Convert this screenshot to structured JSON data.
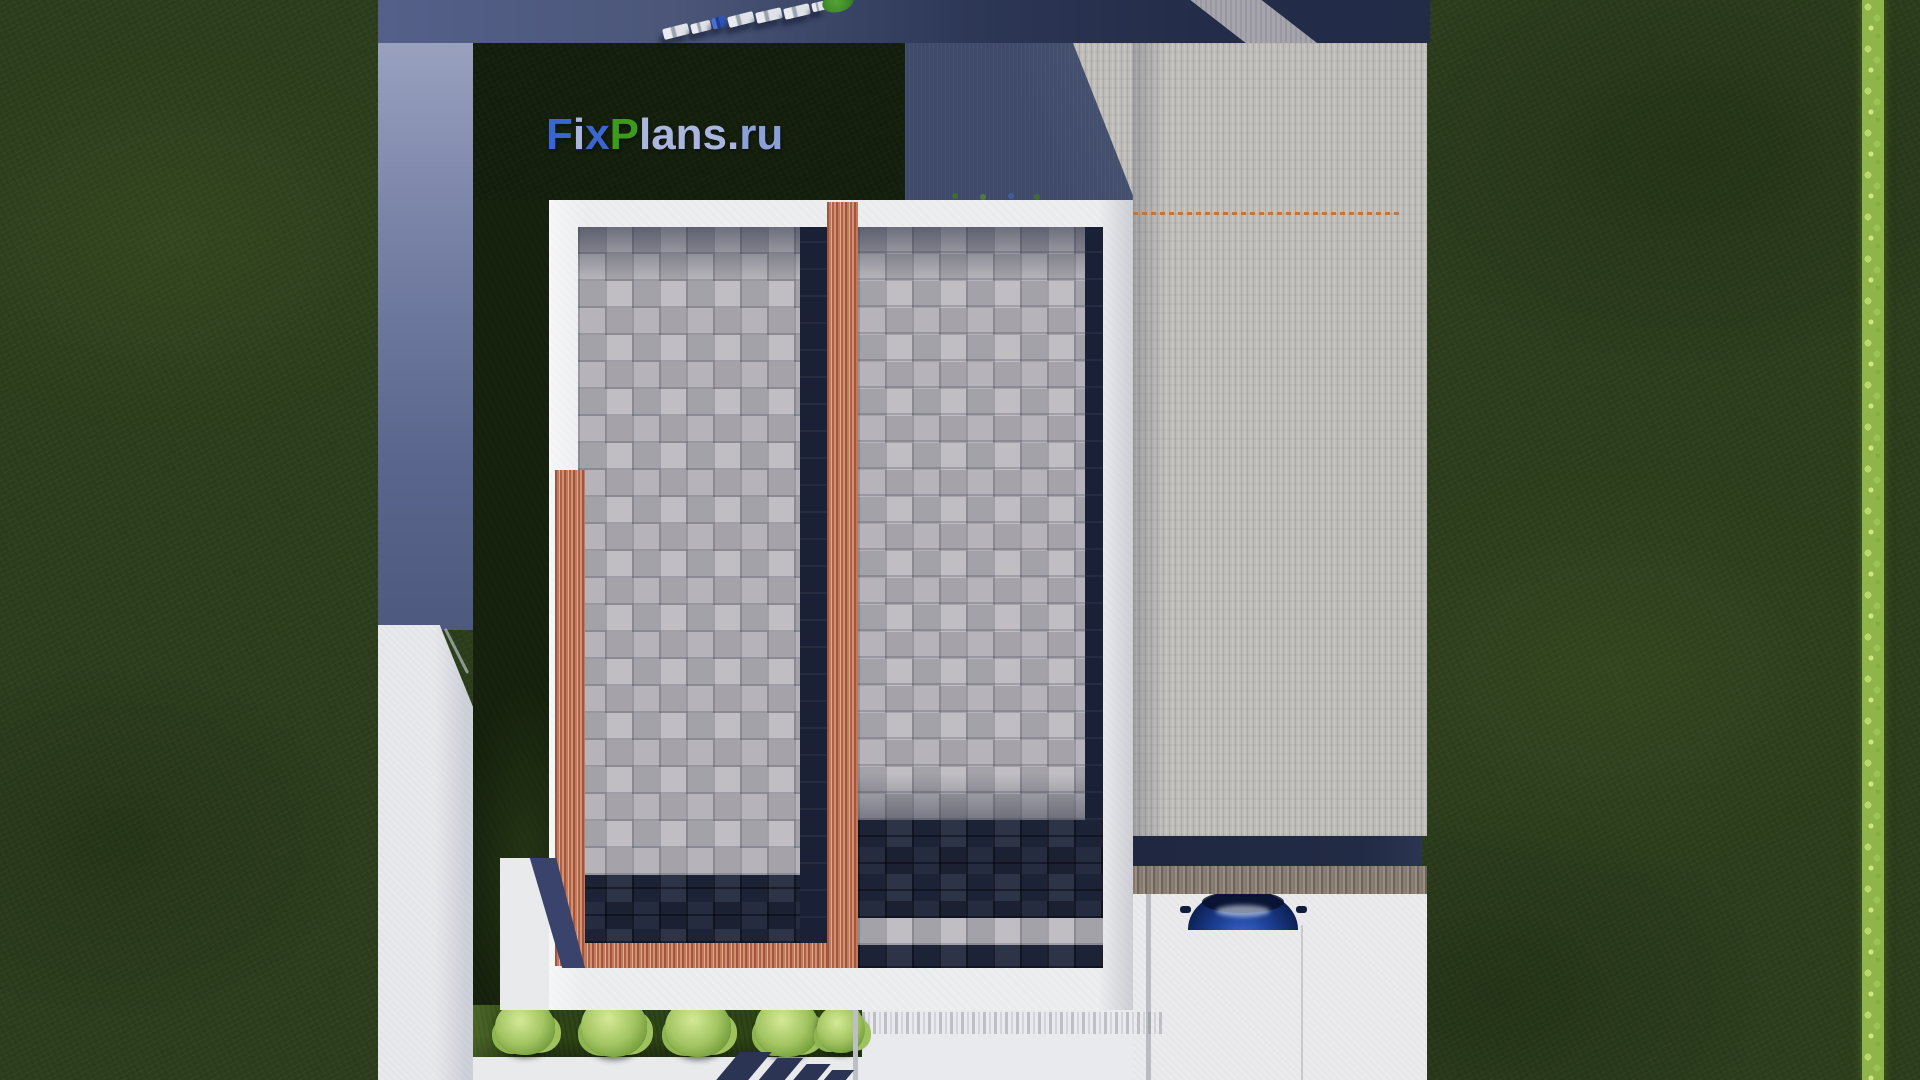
{
  "watermark": {
    "text": "FixPlans.ru",
    "segments": [
      {
        "text": "F"
      },
      {
        "text": "i"
      },
      {
        "text": "x"
      },
      {
        "text": "P"
      },
      {
        "text": "lans"
      },
      {
        "text": "."
      },
      {
        "text": "ru"
      }
    ]
  },
  "scene": {
    "description": "Top-down aerial 3D render of a modern flat-roof house plot with paved yard, concrete parking pad, lawn and street parking",
    "visible_counts": {
      "bushes_in_row": 5,
      "cars_parked_top_street": 7,
      "blue_car_in_driveway": 1
    }
  },
  "colors": {
    "logo_blue": "#3a67cf",
    "logo_green": "#3c9b1d",
    "logo_light": "#aab6de",
    "logo_light_blue": "#8ba0d8",
    "grass": "#2c3d1c",
    "shadowed_yard": "#141f0c",
    "hedge": "#8fb54a",
    "roof_blocks_light": "#aeacb2",
    "roof_blocks_dark": "#1e2539",
    "terracotta_border": "#c27a5e",
    "parapet_white": "#edeef0",
    "concrete_pad": "#bfbdba",
    "paving": "#ebebee",
    "marking_orange": "#c4763a",
    "car_blue": "#1d4096",
    "street_slate": "#4b5679"
  }
}
